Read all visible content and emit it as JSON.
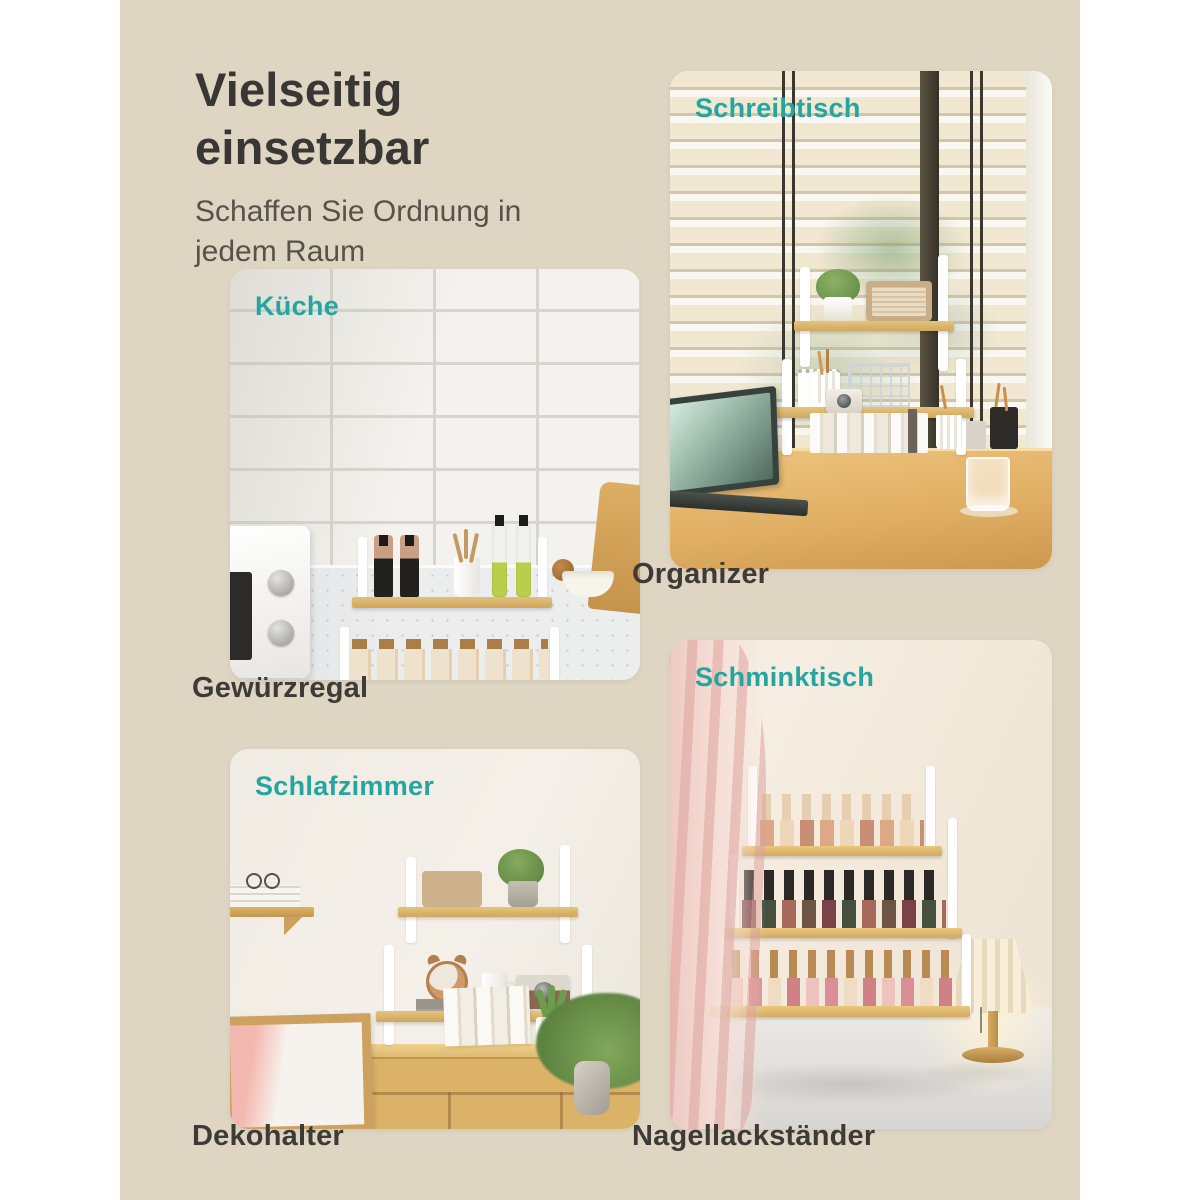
{
  "page": {
    "title": "Vielseitig einsetzbar",
    "subtitle": "Schaffen Sie Ordnung in jedem Raum",
    "background_color": "#ded6c3",
    "page_margin_color": "#ffffff",
    "accent_color": "#23a6a0",
    "title_color": "#393733",
    "caption_color": "#3e3b36"
  },
  "sections": [
    {
      "id": "kueche",
      "label": "Küche",
      "caption": "Gewürzregal",
      "scene": "kitchen spice rack on countertop with subway tiles, microwave, jars and oil bottles"
    },
    {
      "id": "schreibtisch",
      "label": "Schreibtisch",
      "caption": "Organizer",
      "scene": "desk organizer in front of window blinds with laptop, plant, radio, books"
    },
    {
      "id": "schlafzimmer",
      "label": "Schlafzimmer",
      "caption": "Dekohalter",
      "scene": "deco rack on wooden sideboard with radio, plant, alarm clock, camera, books"
    },
    {
      "id": "schminktisch",
      "label": "Schminktisch",
      "caption": "Nagellackständer",
      "scene": "nail polish stand with rows of polish bottles, pink curtain and pleated lamp"
    }
  ]
}
